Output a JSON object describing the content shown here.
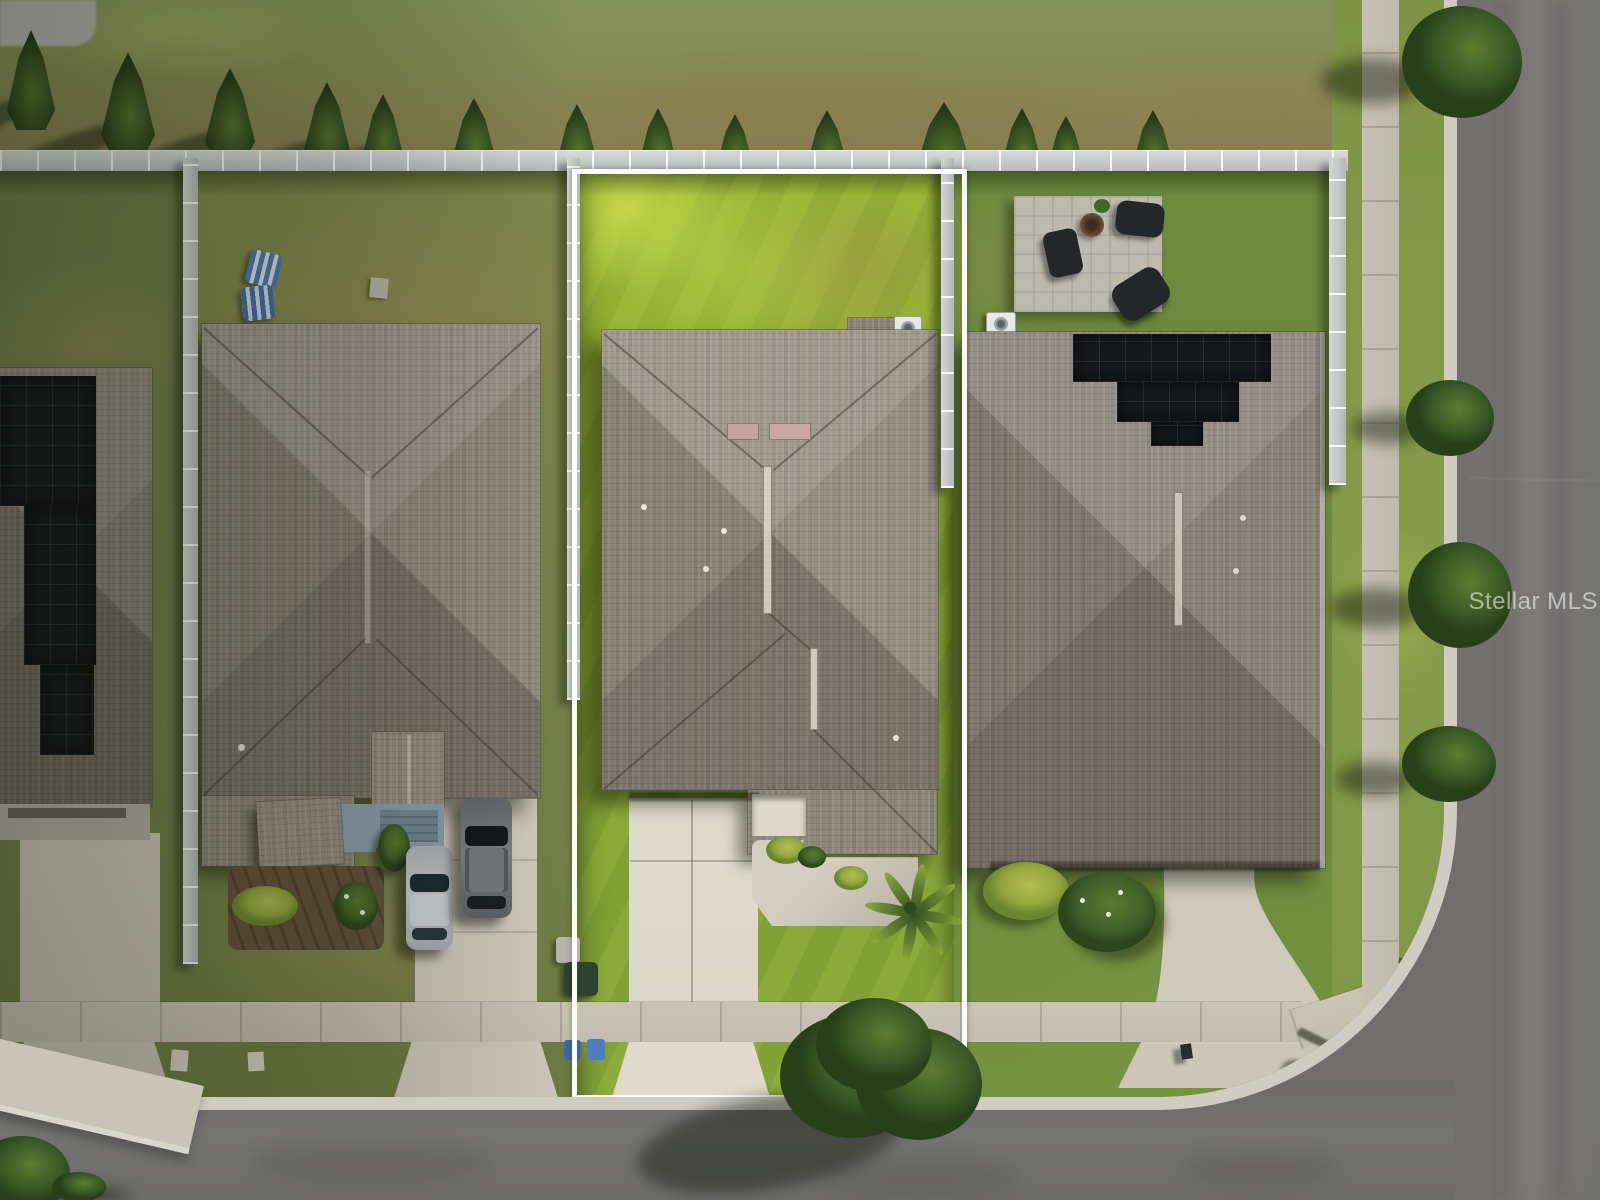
{
  "watermark": {
    "text": "Stellar MLS"
  },
  "scene": {
    "type": "aerial-drone-photo",
    "subject": "single-family home lot outlined in white between two neighboring homes",
    "setting": "suburban corner street viewed straight down",
    "lot_outline_color": "#ffffff",
    "palette": {
      "subject_lawn": "#9ab435",
      "neighbor_lawn_left": "#7f884c",
      "neighbor_lawn_right": "#6d8a3e",
      "dry_grass_band": "#8b7f57",
      "roof_shingle": "#8d8679",
      "solar_panel": "#17191c",
      "vinyl_fence": "#c9cdcc",
      "sidewalk_concrete": "#c6c1b2",
      "subject_driveway": "#ded9ca",
      "asphalt_road": "#747270",
      "tree_foliage": "#3a5a26",
      "mulch_bed": "#63523a",
      "paver_patio": "#bdbab0",
      "tactile_ramp_pad": "#cd8057",
      "street_sign": "#2f7f72",
      "watermark_text": "rgba(255,255,255,0.55)"
    },
    "objects": {
      "houses_visible": 4,
      "cypress_trees_back_row": 14,
      "right_verge_trees": 4,
      "cars_in_left_driveway": [
        {
          "type": "sedan",
          "color": "silver"
        },
        {
          "type": "suv",
          "color": "gray"
        }
      ],
      "solar_roofs": [
        "far-left house",
        "right house"
      ],
      "subject_house_features": [
        "hip shingle roof",
        "two pink ridge vents",
        "ac unit",
        "white entry stoop",
        "gravel landscape bed",
        "palm tree",
        "street tree over outline"
      ],
      "right_house_features": [
        "paver patio",
        "covered patio furniture",
        "grill",
        "round table",
        "s-curved driveway",
        "ac unit"
      ],
      "left_house_features": [
        "two blue lawn loungers",
        "mulch flower bed",
        "porch gable",
        "two parked cars"
      ],
      "street_items": [
        "sidewalks",
        "curb ramp with orange tactile pad",
        "street name sign",
        "street light shadow",
        "trash bins",
        "blue recycle bins",
        "mailbox"
      ]
    }
  }
}
